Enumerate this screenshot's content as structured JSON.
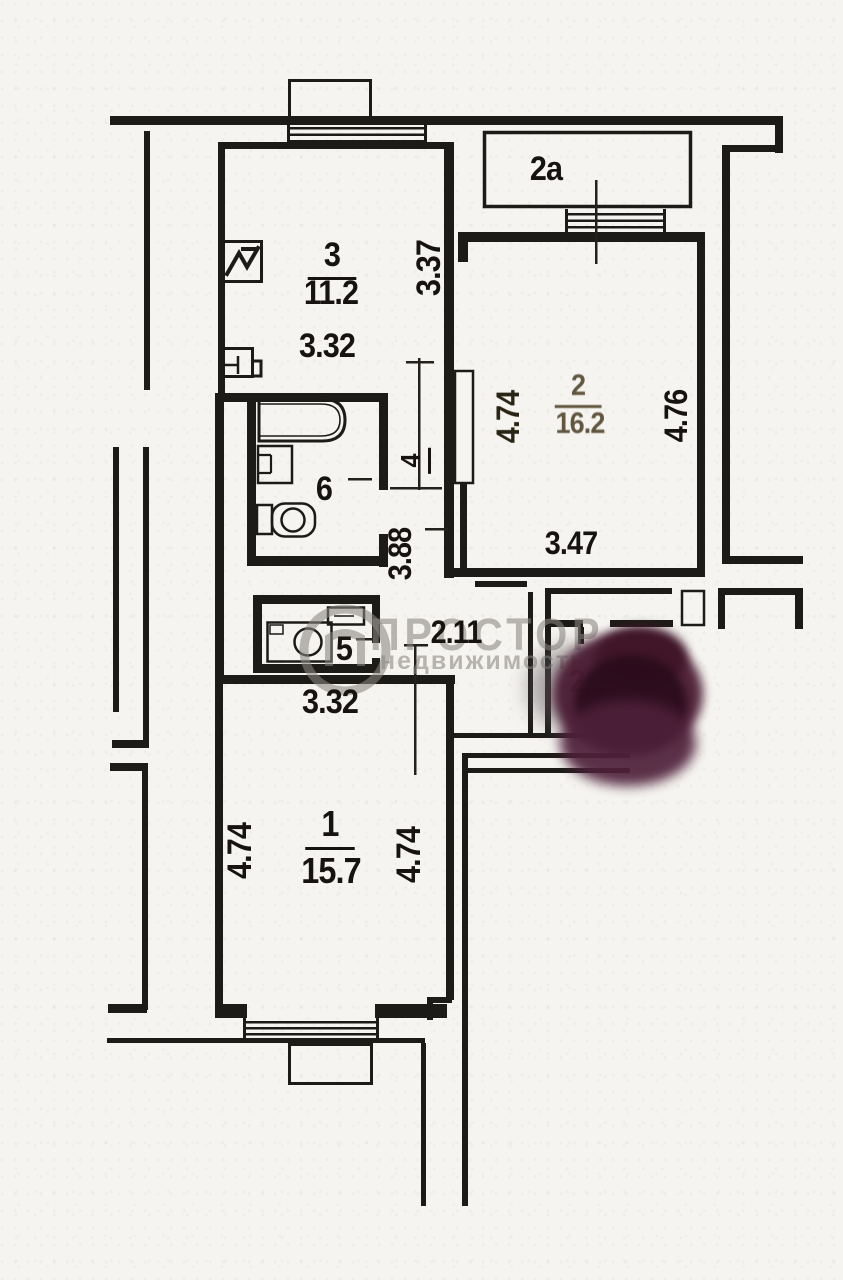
{
  "plan": {
    "watermark": {
      "brand": "ПРОСТОР",
      "brand_sub": "недвижимость"
    },
    "rooms": {
      "r1": {
        "number": "1",
        "area": "15.7",
        "dim_left": "4.74",
        "dim_right": "4.74",
        "dim_width": "3.32"
      },
      "r2": {
        "number": "2",
        "area": "16.2",
        "dim_left": "4.74",
        "dim_right": "4.76",
        "dim_width": "3.47"
      },
      "r2a": {
        "number": "2а"
      },
      "r3": {
        "number": "3",
        "area": "11.2",
        "dim_width": "3.32",
        "dim_height": "3.37"
      },
      "r4": {
        "number": "4",
        "dim_length": "3.88"
      },
      "r5": {
        "number": "5"
      },
      "r6": {
        "number": "6"
      }
    },
    "hall": {
      "dim_width": "2.11",
      "dim_obscured": "2.2"
    },
    "colors": {
      "paper": "#f5f4f0",
      "ink": "#1d1b18",
      "faded_ink": "#4d4128",
      "blob": "#3a1226",
      "watermark_gray": "#8a8782"
    },
    "icons": [
      "stove-icon",
      "kitchen-sink-icon",
      "bathtub-icon",
      "washbasin-icon",
      "toilet-icon",
      "washing-machine-icon",
      "small-sink-icon"
    ]
  }
}
